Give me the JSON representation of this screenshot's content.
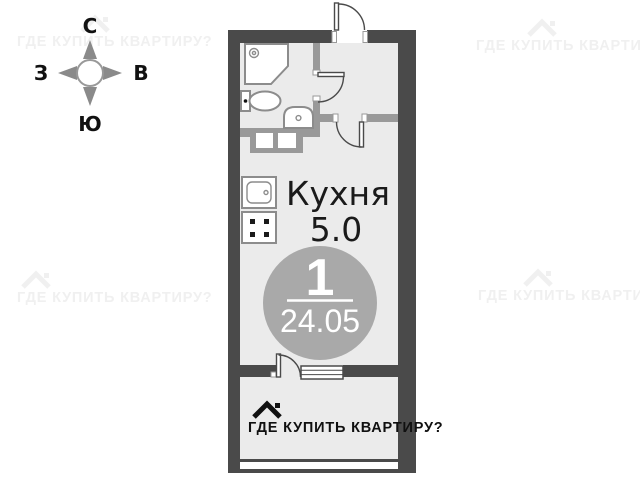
{
  "watermark": {
    "text": "ГДЕ КУПИТЬ КВАРТИРУ?"
  },
  "compass": {
    "north": "С",
    "east": "В",
    "south": "Ю",
    "west": "З"
  },
  "plan": {
    "room": {
      "label": "Кухня",
      "area": "5.0"
    },
    "badge": {
      "rooms": "1",
      "total_area": "24.05"
    },
    "colors": {
      "wall": "#4a4a4a",
      "partition": "#999999",
      "floor": "#ebebeb",
      "badge_circle": "#a9a9a9",
      "fixture_outline": "#8c8c8c"
    }
  }
}
